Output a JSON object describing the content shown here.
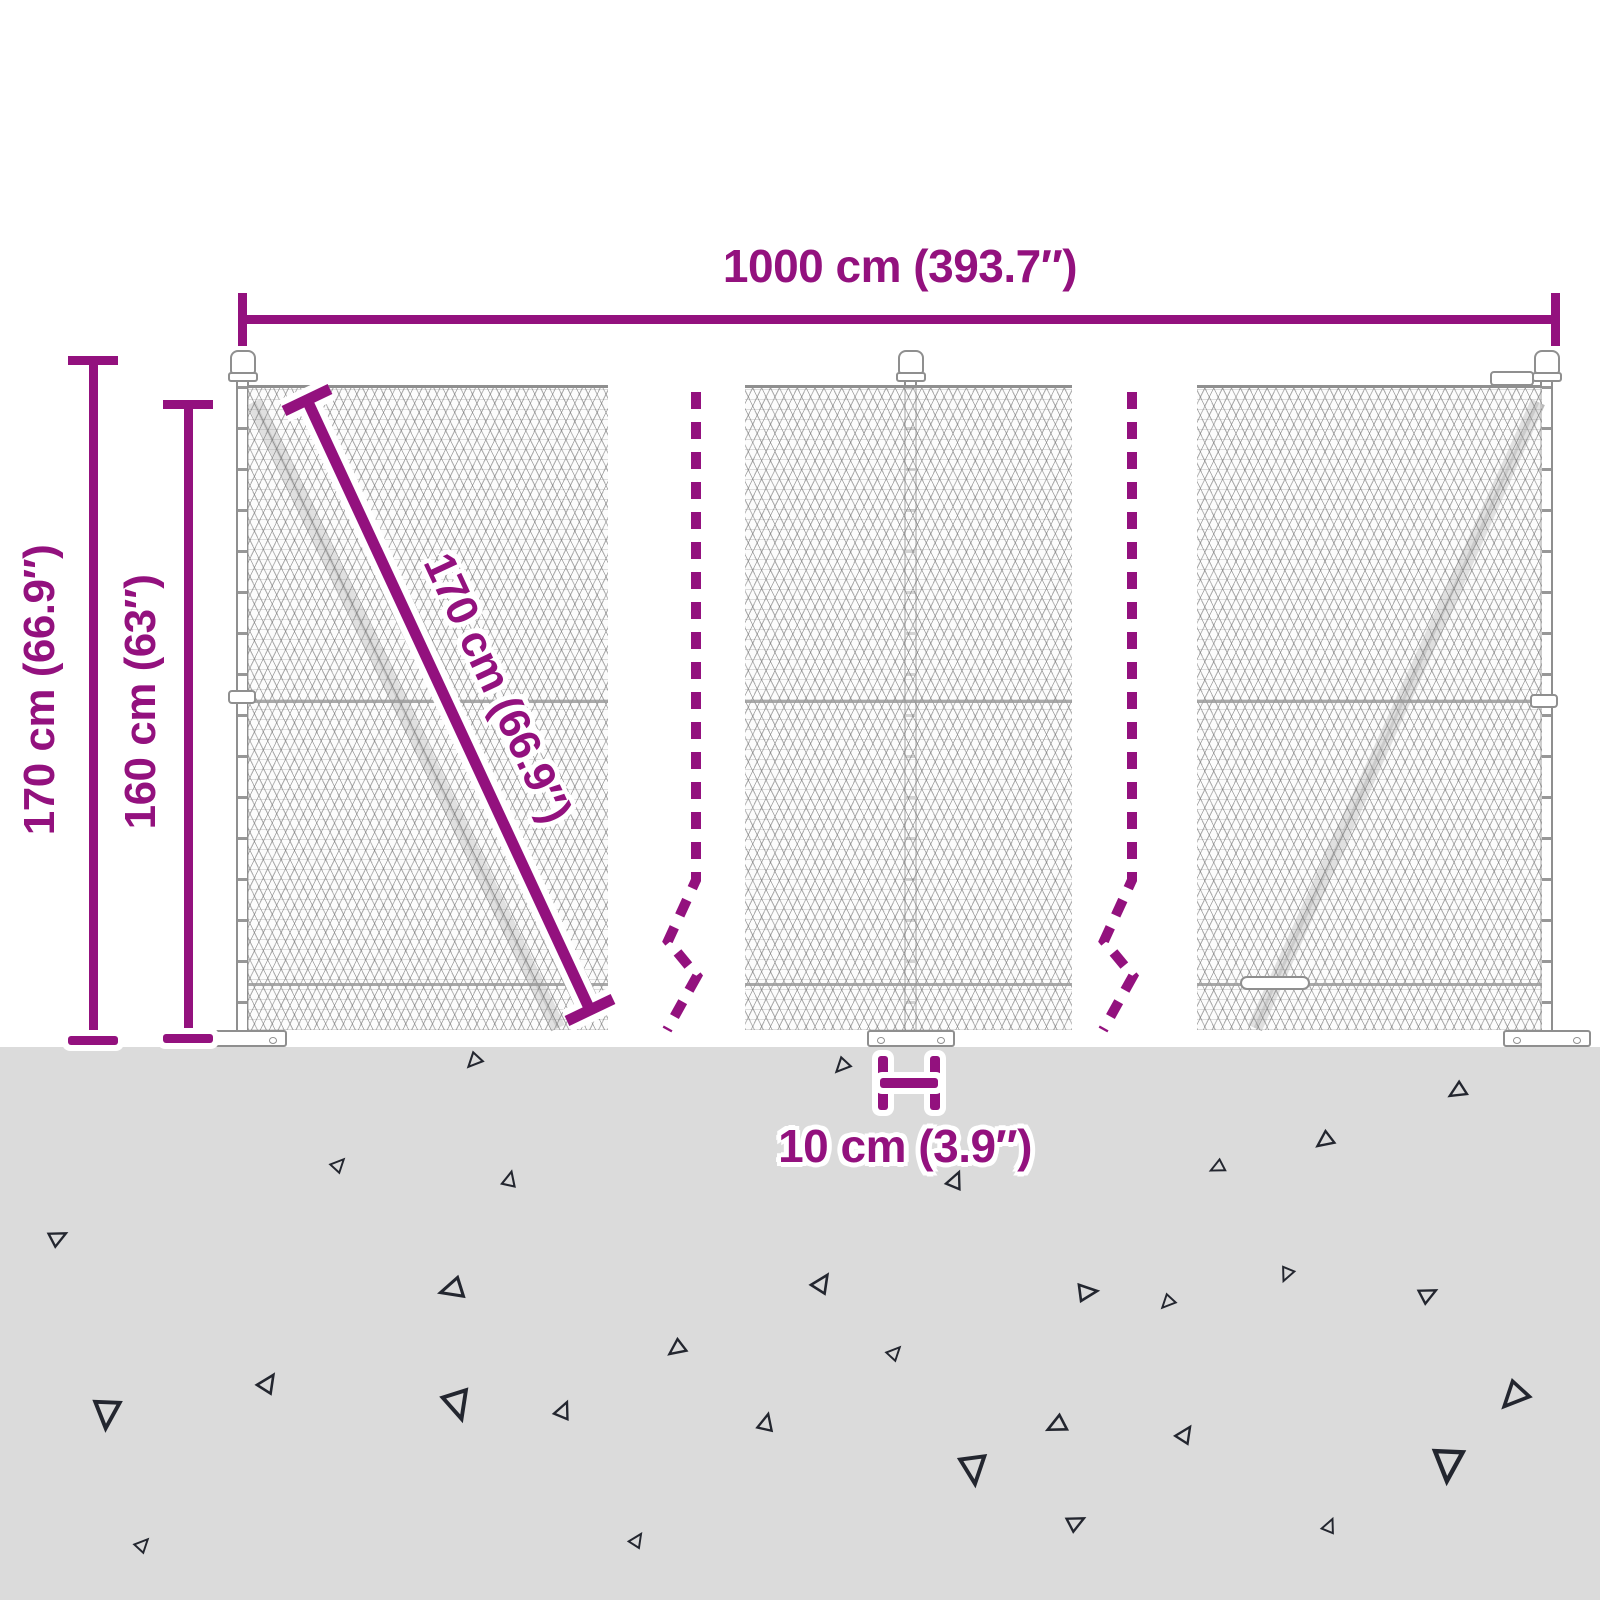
{
  "dimensions": {
    "width": {
      "label": "1000 cm (393.7″)"
    },
    "total_height": {
      "label": "170 cm (66.9″)"
    },
    "mesh_height": {
      "label": "160 cm (63″)"
    },
    "diagonal": {
      "label": "170 cm (66.9″)"
    },
    "spacing": {
      "label": "10 cm (3.9″)"
    }
  },
  "colors": {
    "dimension_accent": "#93117E",
    "ground": "#DBDBDB",
    "mesh_wire": "#9A9A9A",
    "triangle_outline": "#23262F"
  }
}
